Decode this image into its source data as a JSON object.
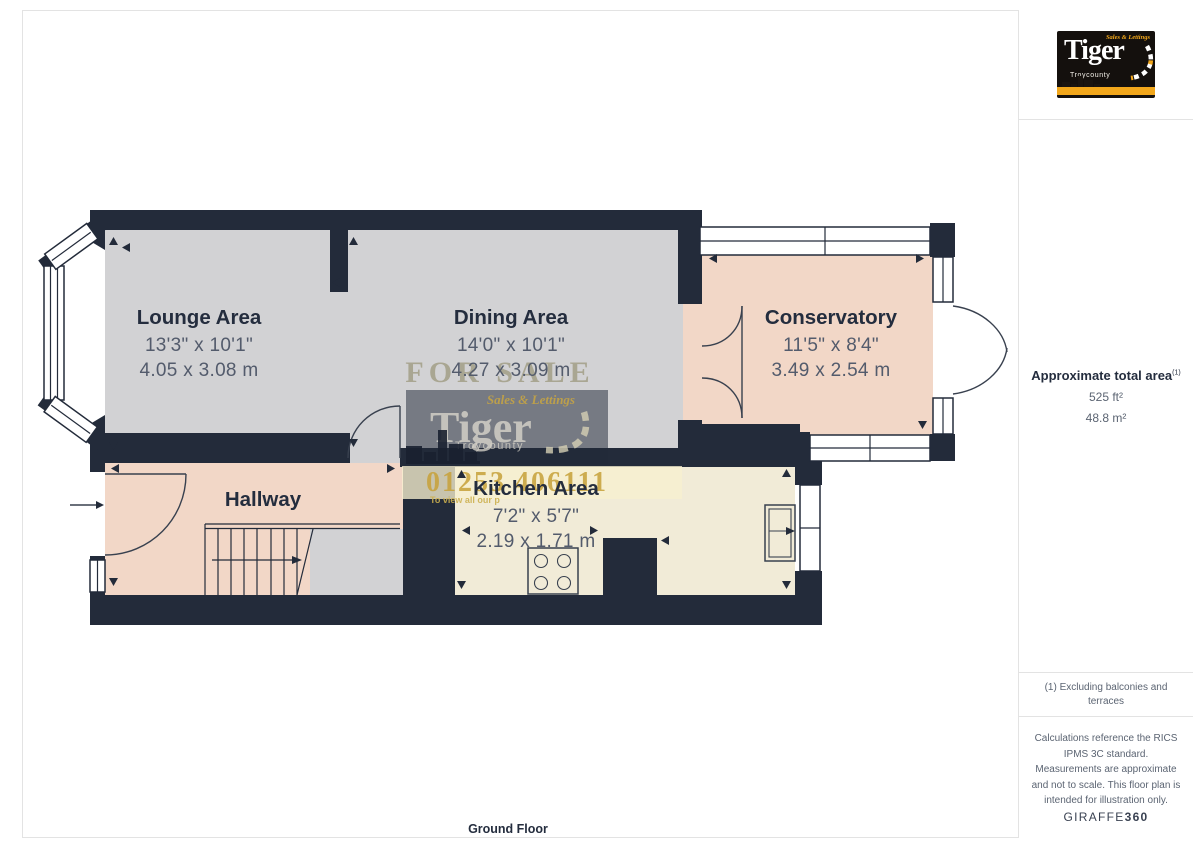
{
  "floorplan": {
    "title": "Ground Floor",
    "rooms": [
      {
        "name": "Lounge Area",
        "dims_imperial": "13'3\" x 10'1\"",
        "dims_metric": "4.05 x 3.08 m"
      },
      {
        "name": "Dining Area",
        "dims_imperial": "14'0\" x 10'1\"",
        "dims_metric": "4.27 x 3.09 m"
      },
      {
        "name": "Conservatory",
        "dims_imperial": "11'5\" x 8'4\"",
        "dims_metric": "3.49 x 2.54 m"
      },
      {
        "name": "Hallway"
      },
      {
        "name": "Kitchen Area",
        "dims_imperial": "7'2\" x 5'7\"",
        "dims_metric": "2.19 x 1.71 m"
      }
    ],
    "watermark": {
      "line1": "FOR SALE",
      "brand": "Tiger",
      "script": "Sales & Lettings",
      "sub": "Troycounty",
      "phone": "01253 406111",
      "tagline": "To view all our p"
    }
  },
  "sidebar": {
    "logo": {
      "brand": "Tiger",
      "script": "Sales & Lettings",
      "sub": "Troycounty"
    },
    "area": {
      "label": "Approximate total area",
      "footnote_marker": "(1)",
      "imperial": "525 ft²",
      "metric": "48.8 m²"
    },
    "note": "(1) Excluding balconies and terraces",
    "disclaimer": "Calculations reference the RICS IPMS 3C standard. Measurements are approximate and not to scale. This floor plan is intended for illustration only.",
    "credit": {
      "name": "GIRAFFE",
      "num": "360"
    }
  },
  "colors": {
    "wall": "#232b3a",
    "floor_gray": "#d2d2d4",
    "floor_pink": "#f2d7c7",
    "floor_cream": "#f1ebd7",
    "tiger_yellow": "#f2a71b",
    "text_dark": "#242d3e",
    "text_dim": "#535b6c"
  }
}
